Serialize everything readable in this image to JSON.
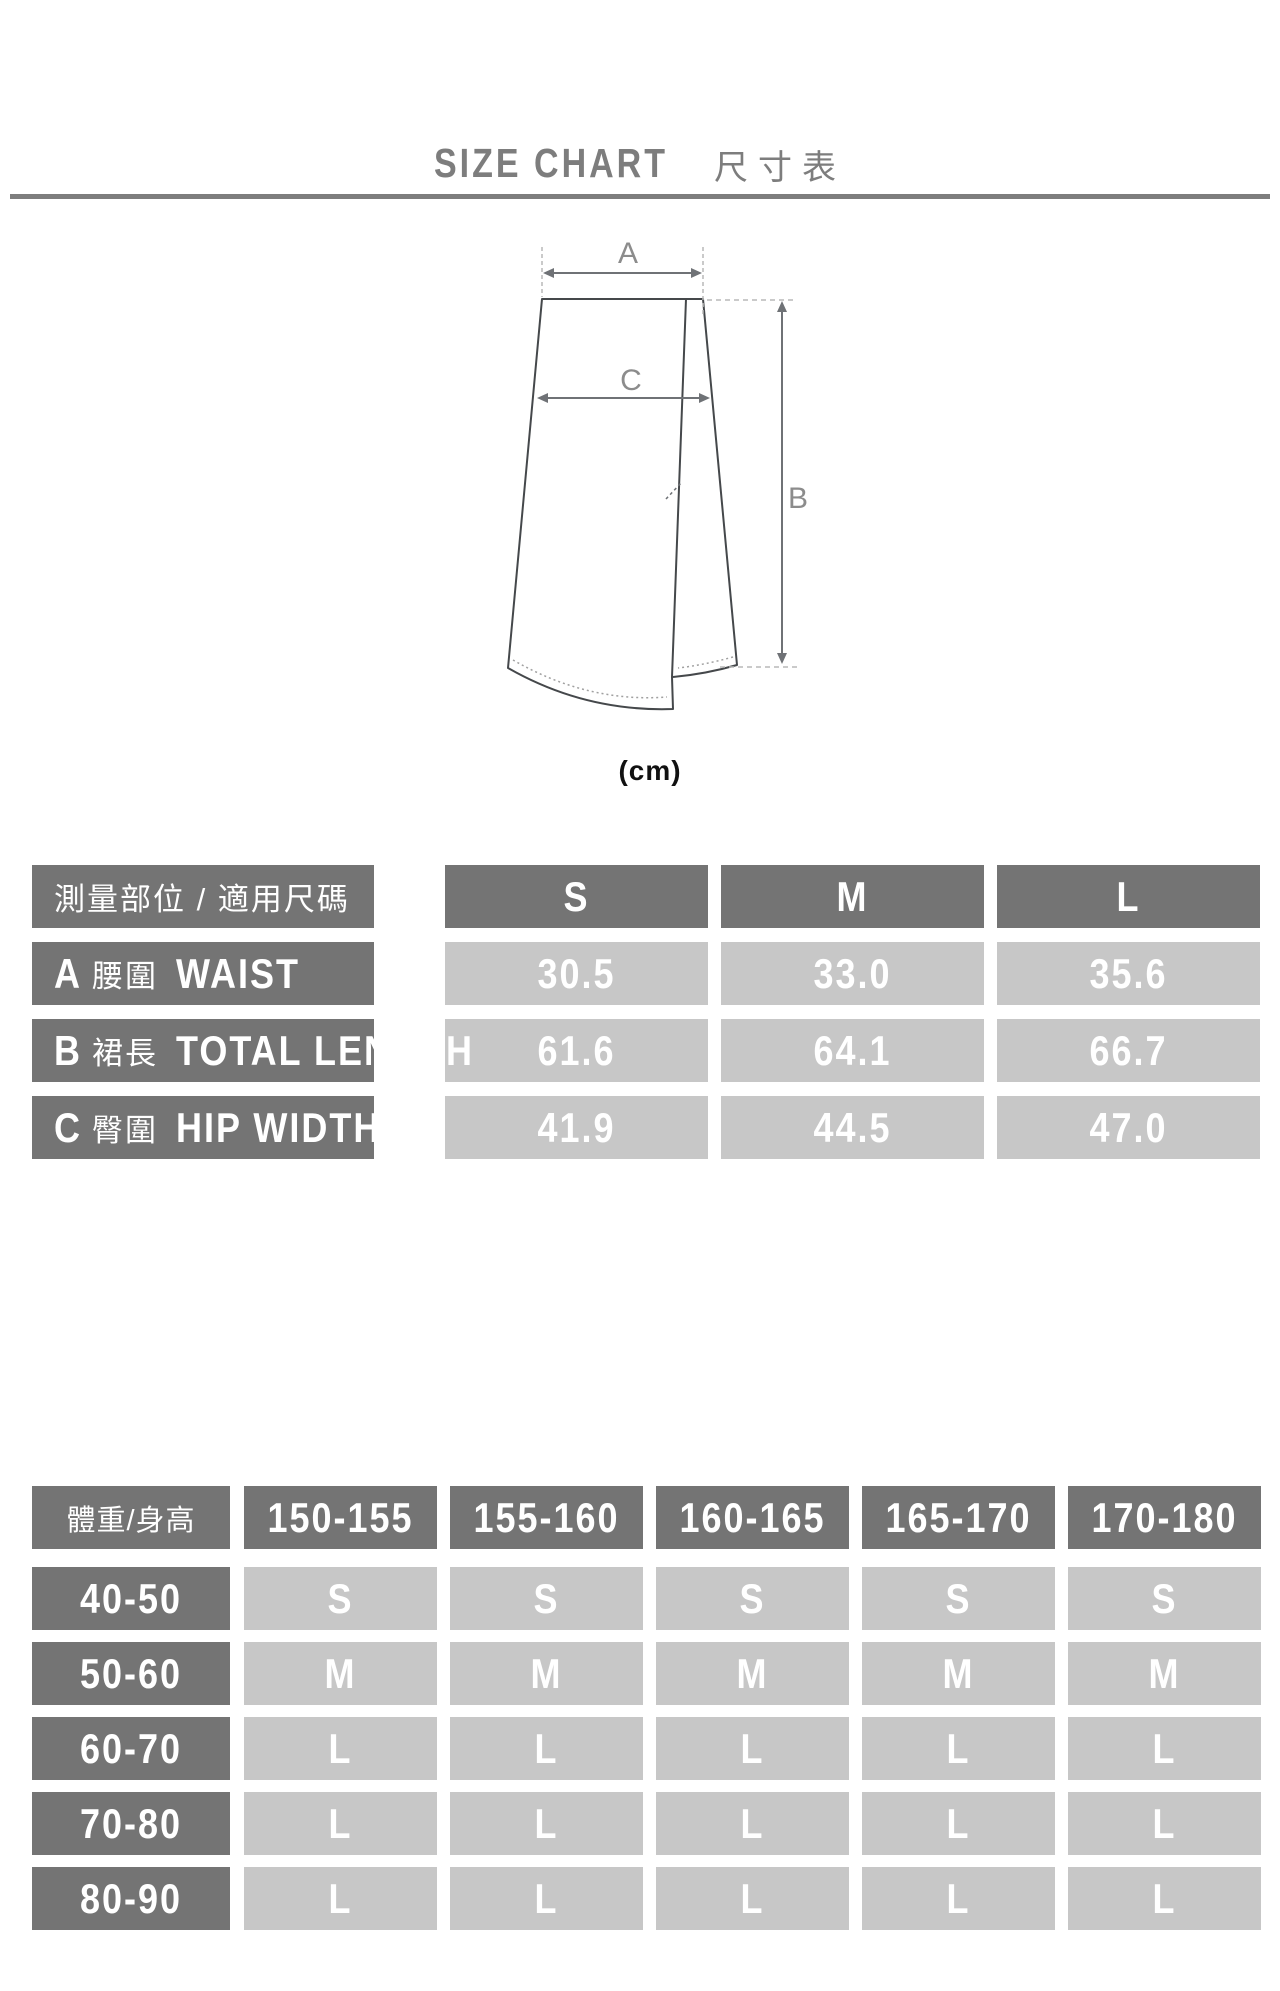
{
  "title": {
    "en": "SIZE CHART",
    "zh": "尺寸表"
  },
  "diagram": {
    "label_a": "A",
    "label_b": "B",
    "label_c": "C",
    "unit": "(cm)"
  },
  "colors": {
    "dark_cell": "#747474",
    "light_cell": "#c7c7c7",
    "title_gray": "#7d7d7d",
    "outline_gray": "#45484b",
    "arrow_gray": "#6f7276",
    "diagram_label_gray": "#8c8c8c"
  },
  "measure_table": {
    "header_label": "測量部位 / 適用尺碼",
    "size_headers": [
      "S",
      "M",
      "L"
    ],
    "rows": [
      {
        "key": "A",
        "part_zh": "腰圍",
        "part_en": "WAIST",
        "values": [
          "30.5",
          "33.0",
          "35.6"
        ]
      },
      {
        "key": "B",
        "part_zh": "裙長",
        "part_en": "TOTAL LENGTH",
        "values": [
          "61.6",
          "64.1",
          "66.7"
        ]
      },
      {
        "key": "C",
        "part_zh": "臀圍",
        "part_en": "HIP WIDTH",
        "values": [
          "41.9",
          "44.5",
          "47.0"
        ]
      }
    ]
  },
  "fit_table": {
    "header_label": "體重/身高",
    "height_headers": [
      "150-155",
      "155-160",
      "160-165",
      "165-170",
      "170-180"
    ],
    "rows": [
      {
        "weight": "40-50",
        "sizes": [
          "S",
          "S",
          "S",
          "S",
          "S"
        ]
      },
      {
        "weight": "50-60",
        "sizes": [
          "M",
          "M",
          "M",
          "M",
          "M"
        ]
      },
      {
        "weight": "60-70",
        "sizes": [
          "L",
          "L",
          "L",
          "L",
          "L"
        ]
      },
      {
        "weight": "70-80",
        "sizes": [
          "L",
          "L",
          "L",
          "L",
          "L"
        ]
      },
      {
        "weight": "80-90",
        "sizes": [
          "L",
          "L",
          "L",
          "L",
          "L"
        ]
      }
    ]
  }
}
